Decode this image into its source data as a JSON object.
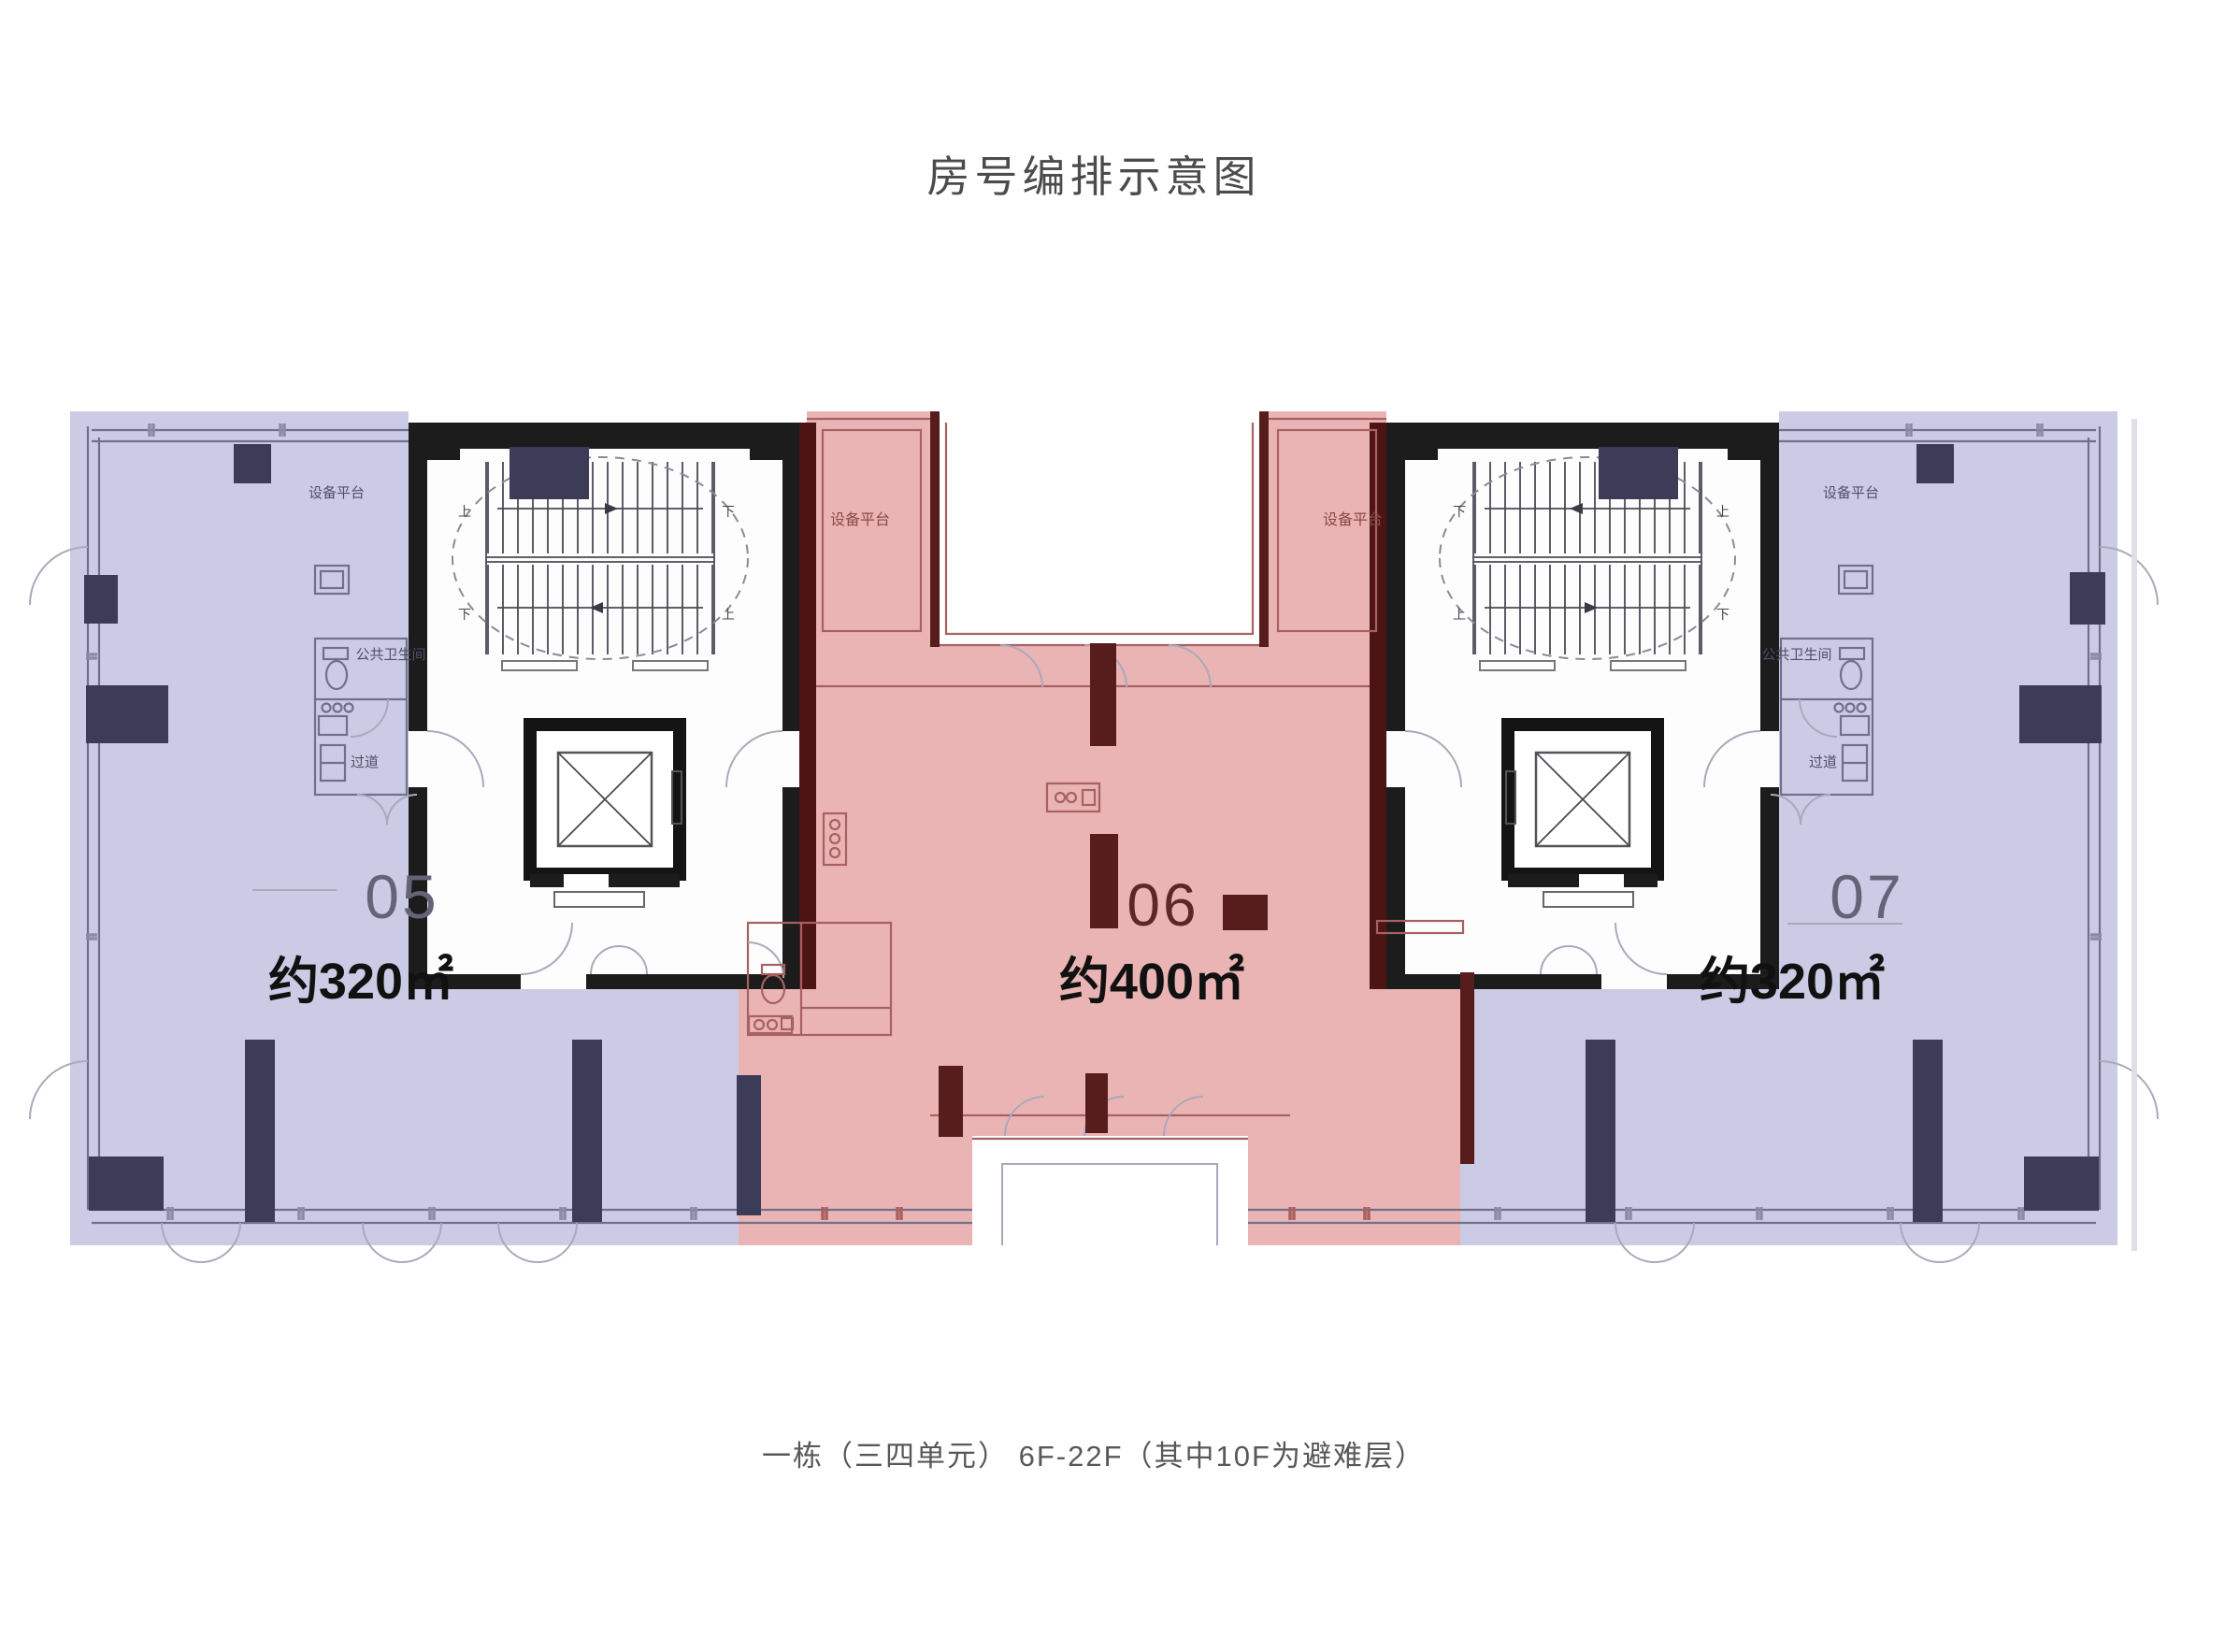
{
  "title": "房号编排示意图",
  "caption": "一栋（三四单元） 6F-22F（其中10F为避难层）",
  "units": [
    {
      "number": "05",
      "area": "约320㎡"
    },
    {
      "number": "06",
      "area": "约400㎡"
    },
    {
      "number": "07",
      "area": "约320㎡"
    }
  ],
  "labels": {
    "equipment_platform": "设备平台",
    "public_restroom": "公共卫生间",
    "corridor": "过道",
    "up": "上",
    "down": "下"
  },
  "colors": {
    "unit_side_tint": "#cbcbe5",
    "unit_center_tint": "#eab4b4",
    "column_side": "#3c3c58",
    "column_center": "#571d1d",
    "core_wall": "#1c1c1c",
    "junction_wall": "#4d1414",
    "line_side": "#8585ad",
    "line_center": "#a96060",
    "title_color": "#4b4b4b",
    "number_side_color": "#646478",
    "number_center_color": "#5e2727",
    "area_text_color": "#111111"
  }
}
